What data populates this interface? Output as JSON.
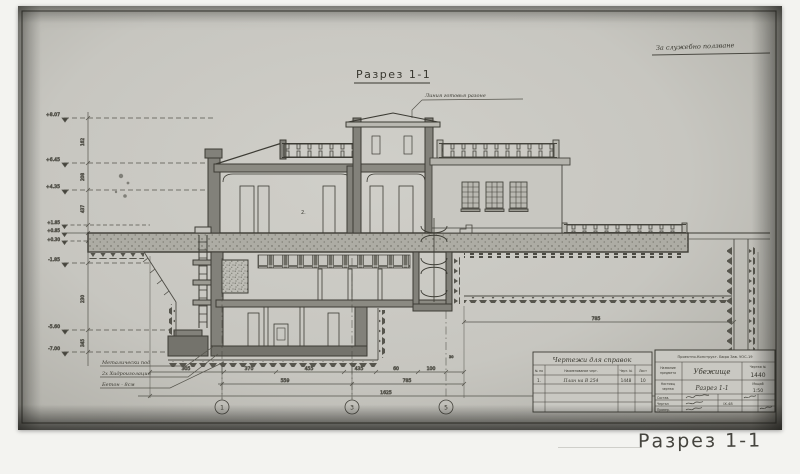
{
  "meta": {
    "caption": "Разрез 1-1"
  },
  "sheet": {
    "title": "Разрез 1-1",
    "stamp": "За служебно ползване",
    "roof_note": "Линия готовья разоне",
    "room_number": "2."
  },
  "materials": [
    "Металически под",
    "2х Хидроизолация",
    "Бетон - 8см"
  ],
  "elevations": [
    "+8.07",
    "+6.45",
    "+4.35",
    "+1.85",
    "+0.85",
    "+0.30",
    "-1.85",
    "-5.60",
    "-7.00"
  ],
  "vdims": [
    "162",
    "208",
    "437",
    "230",
    "345"
  ],
  "dims": {
    "row1": [
      "305",
      "370",
      "455",
      "435",
      "60",
      "100"
    ],
    "row2": [
      "559",
      "785"
    ],
    "total": "1625",
    "right_span": "785",
    "small": "30"
  },
  "axes": [
    "1",
    "3",
    "5"
  ],
  "ref_table": {
    "title": "Чертежи для справок",
    "headers": [
      "№ по",
      "Наименование черт.",
      "Черт. №",
      "Лист"
    ],
    "row": {
      "no": "1.",
      "name": "План на В 254",
      "sheet": "1448",
      "copy": "10"
    }
  },
  "tb": {
    "org": "Проектно-Конструкт. Бюро Зав. УОС-19",
    "object_label_1": "Название",
    "object_label_2": "предмета",
    "object": "Убежище",
    "sheet_label": "Чертеж №",
    "sheet_no": "1440",
    "drawing_label_1": "Настоящ",
    "drawing_label_2": "чертеж",
    "drawing": "Разрез 1-1",
    "scale_label": "Мащаб",
    "scale": "1:50",
    "signs": [
      "Состав.",
      "Чертал",
      "Провер."
    ],
    "date": "IX.48"
  }
}
